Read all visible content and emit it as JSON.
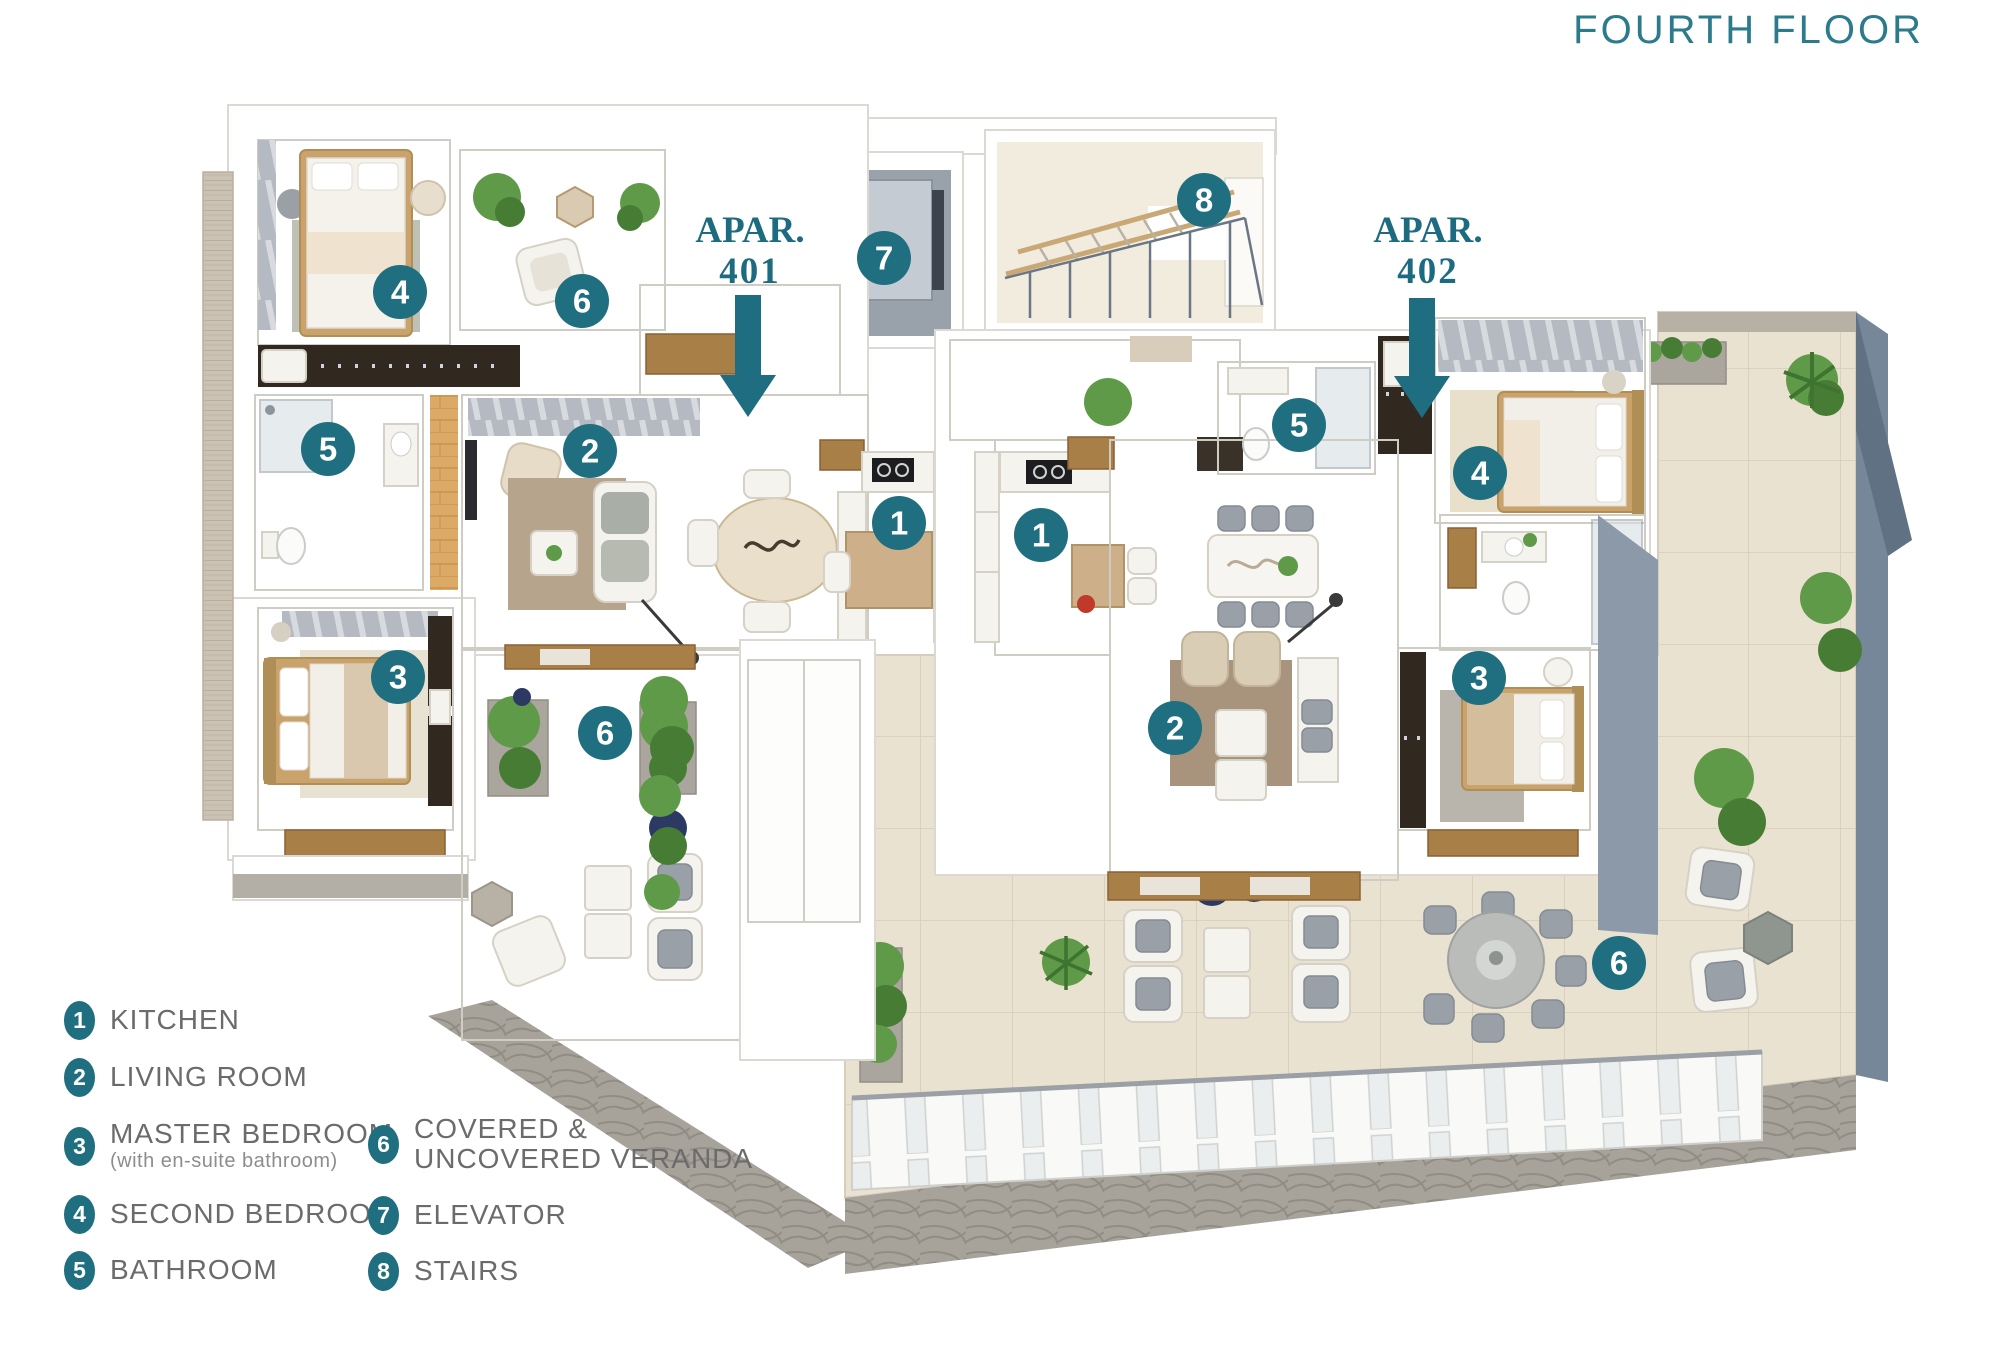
{
  "title": "FOURTH FLOOR",
  "apartments": [
    {
      "name": "APAR.",
      "number": "401"
    },
    {
      "name": "APAR.",
      "number": "402"
    }
  ],
  "badges": [
    {
      "num": "4",
      "room": "second-bedroom-401",
      "x": 400,
      "y": 292
    },
    {
      "num": "6",
      "room": "covered-veranda-401-upper",
      "x": 582,
      "y": 301
    },
    {
      "num": "5",
      "room": "bathroom-401",
      "x": 328,
      "y": 449
    },
    {
      "num": "2",
      "room": "living-room-401",
      "x": 590,
      "y": 451
    },
    {
      "num": "1",
      "room": "kitchen-401",
      "x": 899,
      "y": 523
    },
    {
      "num": "1",
      "room": "kitchen-402",
      "x": 1041,
      "y": 535
    },
    {
      "num": "3",
      "room": "master-bedroom-401",
      "x": 398,
      "y": 677
    },
    {
      "num": "6",
      "room": "veranda-401-lower",
      "x": 605,
      "y": 733
    },
    {
      "num": "7",
      "room": "elevator",
      "x": 884,
      "y": 258
    },
    {
      "num": "8",
      "room": "stairs",
      "x": 1204,
      "y": 200
    },
    {
      "num": "5",
      "room": "bathroom-402",
      "x": 1299,
      "y": 425
    },
    {
      "num": "4",
      "room": "second-bedroom-402",
      "x": 1480,
      "y": 473
    },
    {
      "num": "3",
      "room": "master-bedroom-402",
      "x": 1479,
      "y": 678
    },
    {
      "num": "2",
      "room": "living-room-402",
      "x": 1175,
      "y": 728
    },
    {
      "num": "6",
      "room": "veranda-402-terrace",
      "x": 1619,
      "y": 963
    }
  ],
  "legend": {
    "col1": [
      {
        "num": "1",
        "label": "KITCHEN"
      },
      {
        "num": "2",
        "label": "LIVING ROOM"
      },
      {
        "num": "3",
        "label": "MASTER BEDROOM",
        "sub": "(with en-suite bathroom)"
      },
      {
        "num": "4",
        "label": "SECOND BEDROOM"
      },
      {
        "num": "5",
        "label": "BATHROOM"
      }
    ],
    "col2": [
      {
        "num": "6",
        "label": "COVERED &",
        "label2": "UNCOVERED VERANDA"
      },
      {
        "num": "7",
        "label": "ELEVATOR"
      },
      {
        "num": "8",
        "label": "STAIRS"
      }
    ]
  },
  "colors": {
    "accent_teal": "#1f6f80",
    "title_teal": "#2b7b8c",
    "legend_text": "#6b6b6b"
  }
}
